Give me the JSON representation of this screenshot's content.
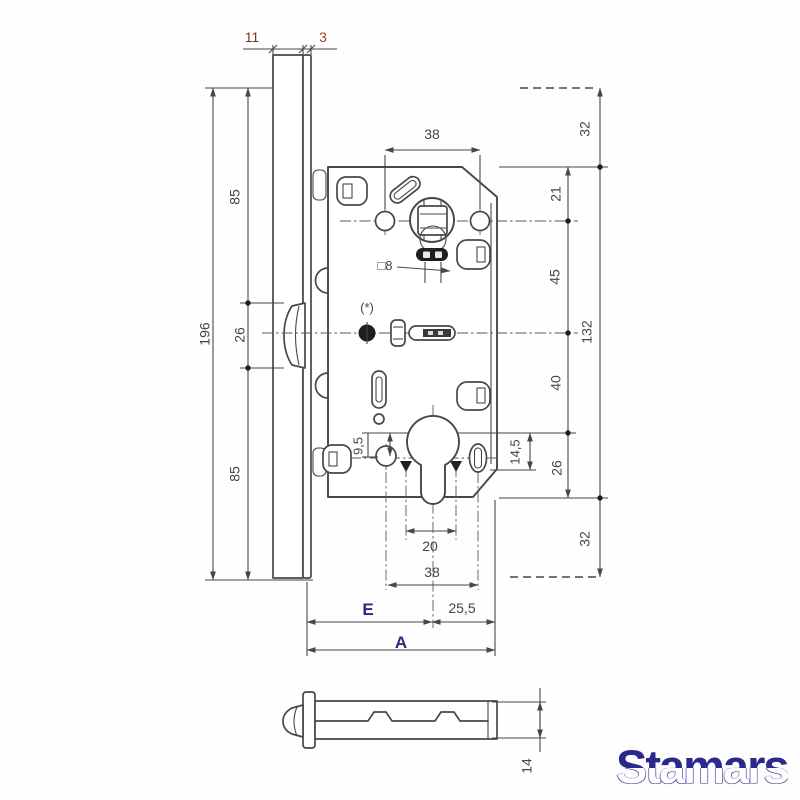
{
  "drawing": {
    "annotations": {
      "star_note": "(*)",
      "square_spindle": "□8"
    },
    "dimensions": {
      "faceplate_lip": "11",
      "faceplate_thickness": "3",
      "left_total": "196",
      "left_top": "85",
      "left_latch": "26",
      "left_bottom": "85",
      "handle_screw_spacing_top": "38",
      "right_offset_top": "32",
      "top_edge_to_handle": "21",
      "handle_to_center": "45",
      "case_height_total": "132",
      "center_to_cylinder": "40",
      "cylinder_to_bottom": "26",
      "right_offset_bottom": "32",
      "cylinder_screw_offset": "14,5",
      "screw_offset_left": "9,5",
      "cylinder_screw_spacing": "20",
      "screw_spacing_bottom": "38",
      "backset_label": "E",
      "cylinder_to_edge": "25,5",
      "total_depth_label": "A",
      "latch_bolt_height": "14"
    },
    "brand": "Stamars"
  }
}
